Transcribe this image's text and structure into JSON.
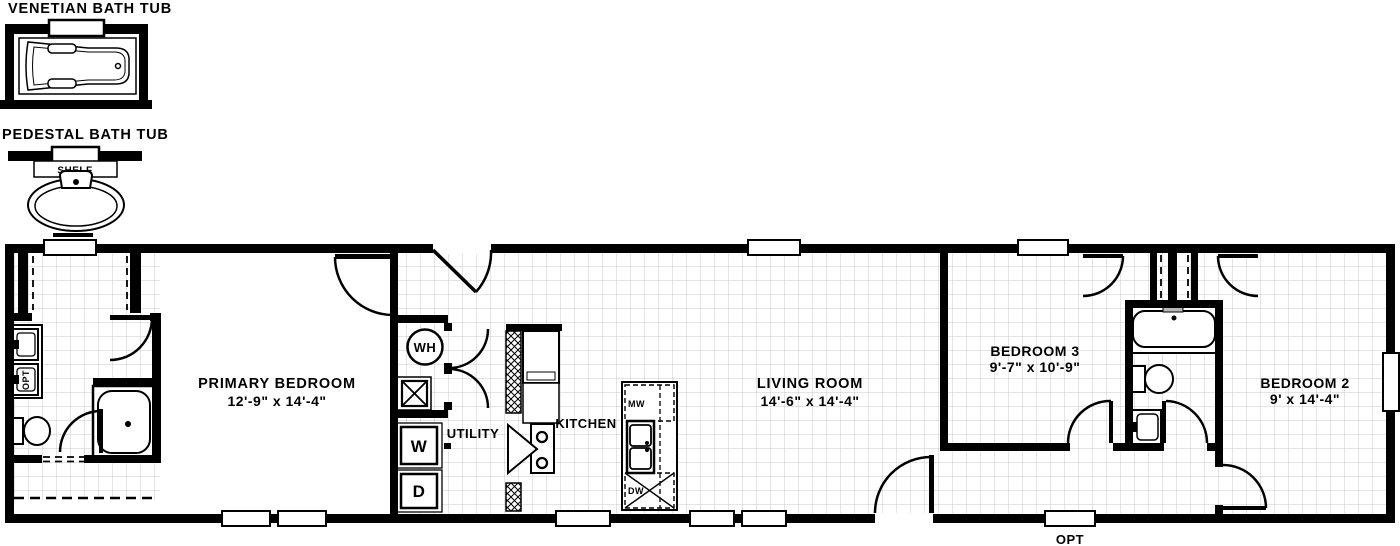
{
  "page": {
    "background": "#ffffff",
    "wall_color": "#000000",
    "grid_color": "#c9c9c9",
    "shelf_tab_color": "#b8b8b8"
  },
  "details": {
    "venetian_tub": {
      "title": "VENETIAN BATH TUB"
    },
    "pedestal_tub": {
      "title": "PEDESTAL BATH TUB",
      "shelf_label": "SHELF"
    }
  },
  "rooms": {
    "primary_bedroom": {
      "name": "PRIMARY BEDROOM",
      "dims": "12'-9\" x 14'-4\""
    },
    "living_room": {
      "name": "LIVING ROOM",
      "dims": "14'-6\" x 14'-4\""
    },
    "bedroom_3": {
      "name": "BEDROOM 3",
      "dims": "9'-7\" x 10'-9\""
    },
    "bedroom_2": {
      "name": "BEDROOM 2",
      "dims": "9' x 14'-4\""
    },
    "kitchen": {
      "name": "KITCHEN"
    },
    "utility": {
      "name": "UTILITY"
    }
  },
  "appliances": {
    "water_heater": "WH",
    "washer": "W",
    "dryer": "D",
    "microwave": "MW",
    "dishwasher": "DW"
  },
  "annotations": {
    "optional_sink": "OPT",
    "optional_window": "OPT"
  }
}
